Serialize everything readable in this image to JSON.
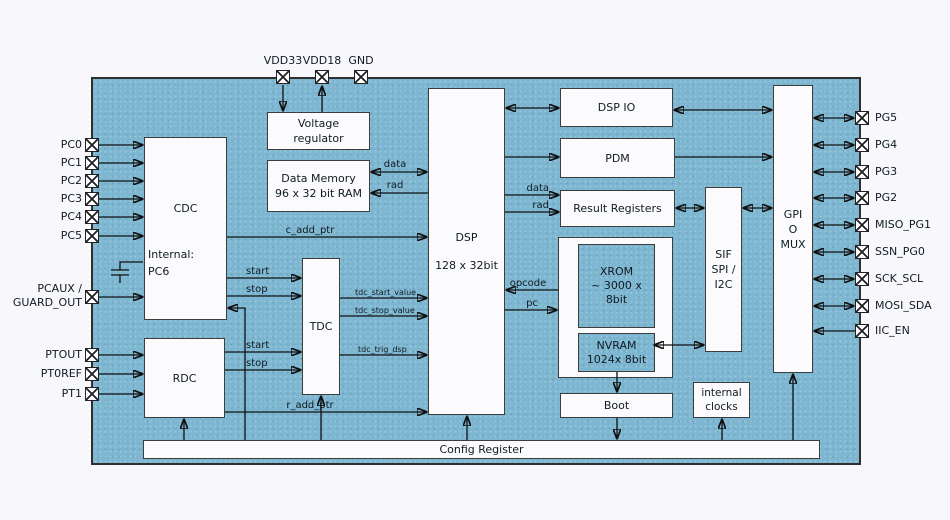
{
  "colors": {
    "page_bg": "#F8F8FC",
    "chip_fill": "#7DB6D1",
    "block_fill": "#FBFBFD",
    "block_border": "#3D3D3D",
    "wire": "#101010",
    "text": "#0F1B22"
  },
  "blocks": {
    "voltage_regulator": {
      "line1": "Voltage",
      "line2": "regulator"
    },
    "data_memory": {
      "line1": "Data Memory",
      "line2": "96 x 32 bit RAM"
    },
    "cdc": {
      "title": "CDC",
      "internal_line1": "Internal:",
      "internal_line2": "PC6"
    },
    "tdc": {
      "title": "TDC"
    },
    "rdc": {
      "title": "RDC"
    },
    "dsp": {
      "title": "DSP",
      "subtitle": "128 x 32bit"
    },
    "dsp_io": {
      "title": "DSP IO"
    },
    "pdm": {
      "title": "PDM"
    },
    "result_registers": {
      "title": "Result Registers"
    },
    "xrom": {
      "line1": "XROM",
      "line2": "~ 3000 x",
      "line3": "8bit"
    },
    "nvram": {
      "line1": "NVRAM",
      "line2": "1024x 8bit"
    },
    "boot": {
      "title": "Boot"
    },
    "internal_clocks": {
      "line1": "internal",
      "line2": "clocks"
    },
    "sif": {
      "line1": "SIF",
      "line2": "SPI /",
      "line3": "I2C"
    },
    "gpio_mux": {
      "line1": "GPI",
      "line2": "O",
      "line3": "MUX"
    },
    "config_register": {
      "title": "Config Register"
    }
  },
  "pins": {
    "top": [
      {
        "label": "VDD33"
      },
      {
        "label": "VDD18"
      },
      {
        "label": "GND"
      }
    ],
    "left_pc": [
      {
        "label": "PC0"
      },
      {
        "label": "PC1"
      },
      {
        "label": "PC2"
      },
      {
        "label": "PC3"
      },
      {
        "label": "PC4"
      },
      {
        "label": "PC5"
      }
    ],
    "pcaux": {
      "line1": "PCAUX /",
      "line2": "GUARD_OUT"
    },
    "left_pt": [
      {
        "label": "PTOUT"
      },
      {
        "label": "PT0REF"
      },
      {
        "label": "PT1"
      }
    ],
    "right": [
      {
        "label": "PG5"
      },
      {
        "label": "PG4"
      },
      {
        "label": "PG3"
      },
      {
        "label": "PG2"
      },
      {
        "label": "MISO_PG1"
      },
      {
        "label": "SSN_PG0"
      },
      {
        "label": "SCK_SCL"
      },
      {
        "label": "MOSI_SDA"
      },
      {
        "label": "IIC_EN"
      }
    ]
  },
  "signals": {
    "c_add_ptr": "c_add_ptr",
    "r_add_ptr": "r_add_ptr",
    "cdc_start": "start",
    "cdc_stop": "stop",
    "rdc_start": "start",
    "rdc_stop": "stop",
    "tdc_start_value": "tdc_start_value",
    "tdc_stop_value": "tdc_stop_value",
    "tdc_trig_dsp": "tdc_trig_dsp",
    "mem_data": "data",
    "mem_rad": "rad",
    "rr_data": "data",
    "rr_rad": "rad",
    "opcode": "opcode",
    "pc": "pc"
  }
}
